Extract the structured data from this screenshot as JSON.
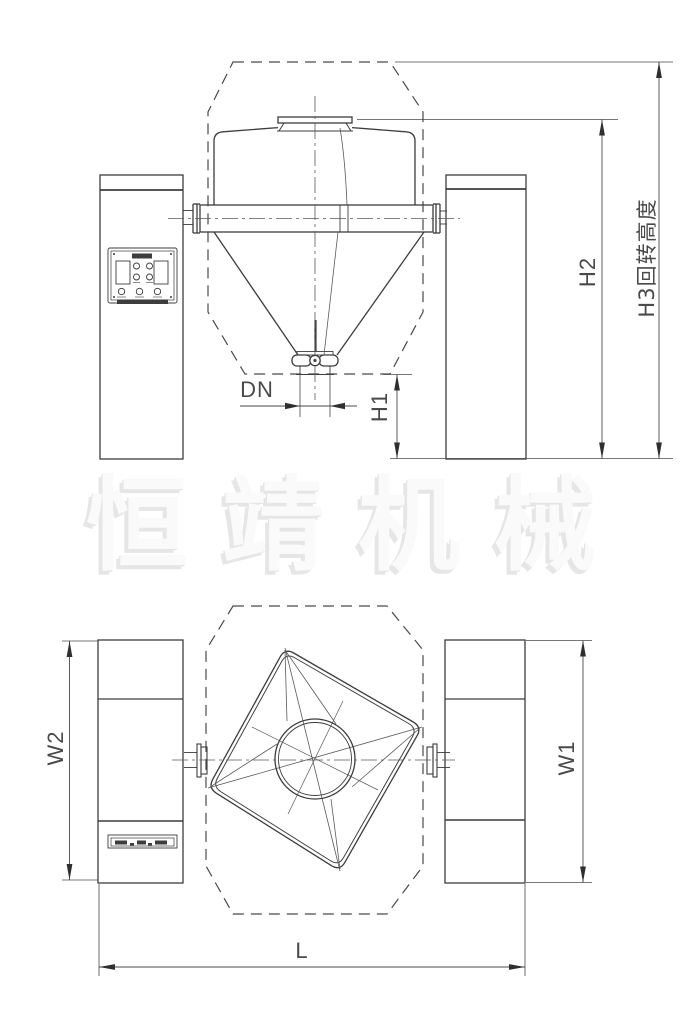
{
  "drawing": {
    "watermark": "恒靖机械",
    "dimensions": {
      "h1": "H1",
      "h2": "H2",
      "h3": "H3回转高度",
      "dn": "DN",
      "w1": "W1",
      "w2": "W2",
      "l": "L"
    },
    "colors": {
      "line": "#3d3d3d",
      "thin_line": "#5a5a5a",
      "dimension": "#4a4a4a",
      "watermark_text": "#fafafa",
      "background": "#ffffff"
    }
  }
}
